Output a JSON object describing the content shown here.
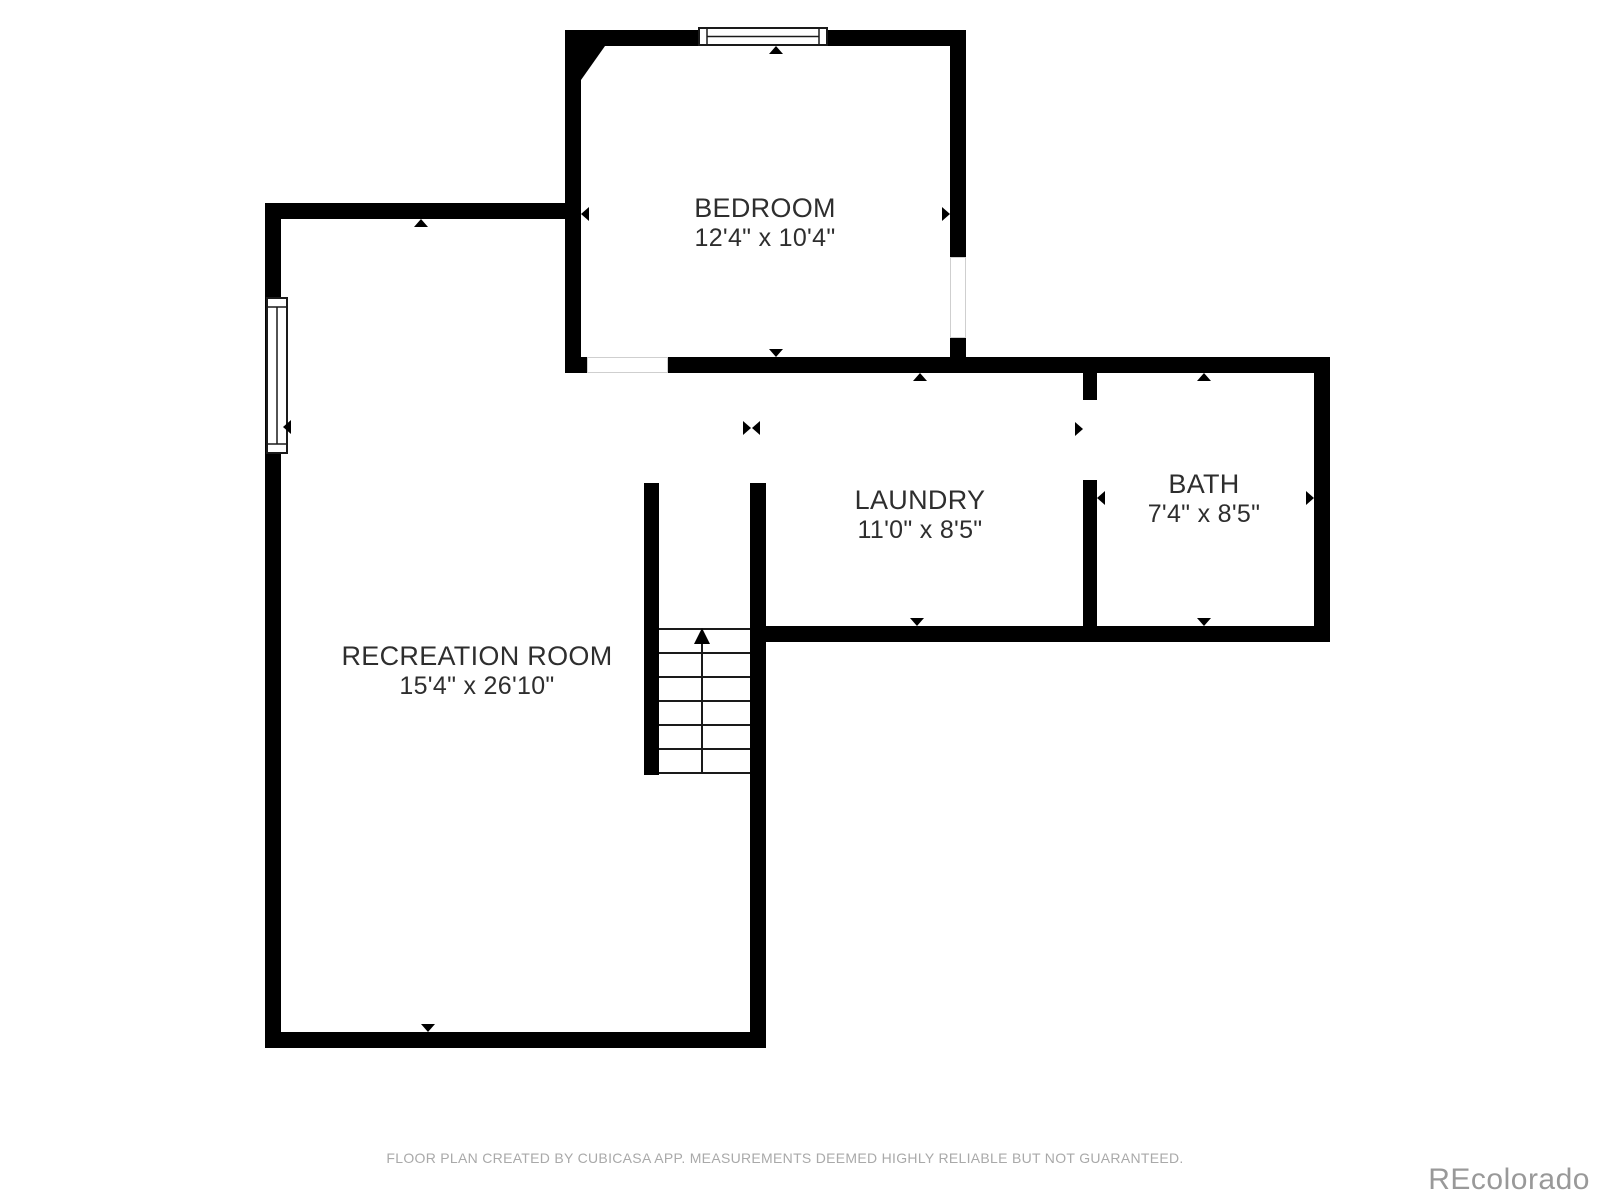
{
  "plan": {
    "rooms": [
      {
        "id": "bedroom",
        "name": "BEDROOM",
        "dimensions": "12'4\" x 10'4\""
      },
      {
        "id": "laundry",
        "name": "LAUNDRY",
        "dimensions": "11'0\" x 8'5\""
      },
      {
        "id": "bath",
        "name": "BATH",
        "dimensions": "7'4\" x 8'5\""
      },
      {
        "id": "recreation_room",
        "name": "RECREATION ROOM",
        "dimensions": "15'4\" x 26'10\""
      }
    ],
    "features": [
      "staircase-up",
      "window-bedroom-top",
      "window-recreation-left",
      "opening-bedroom-right",
      "opening-bedroom-bottom"
    ]
  },
  "footer": {
    "disclaimer": "FLOOR PLAN CREATED BY CUBICASA APP. MEASUREMENTS DEEMED HIGHLY RELIABLE BUT NOT GUARANTEED."
  },
  "watermark": {
    "text": "REcolorado"
  },
  "colors": {
    "wall": "#000000",
    "room_text": "#2e2e2e",
    "footer_text": "#a9a9a9",
    "watermark_text": "#999999",
    "window_border": "#1a1a1a",
    "opening_border": "#cfcfcf"
  }
}
